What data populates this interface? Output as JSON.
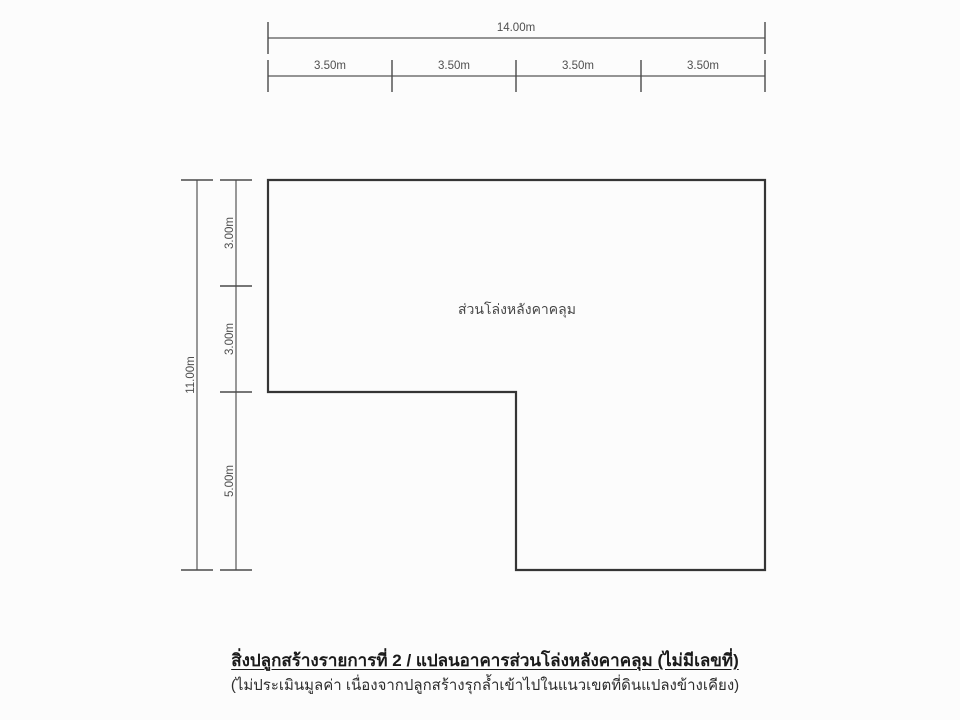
{
  "drawing": {
    "top_dimension": {
      "total_label": "14.00m",
      "segment_labels": [
        "3.50m",
        "3.50m",
        "3.50m",
        "3.50m"
      ]
    },
    "left_dimension": {
      "total_label": "11.00m",
      "segment_labels": [
        "3.00m",
        "3.00m",
        "5.00m"
      ]
    },
    "plan": {
      "area_label": "ส่วนโล่งหลังคาคลุม"
    }
  },
  "caption": {
    "title": "สิ่งปลูกสร้างรายการที่ 2 / แปลนอาคารส่วนโล่งหลังคาคลุม (ไม่มีเลขที่)",
    "subtitle": "(ไม่ประเมินมูลค่า เนื่องจากปลูกสร้างรุกล้ำเข้าไปในแนวเขตที่ดินแปลงข้างเคียง)"
  },
  "colors": {
    "background": "#fcfcfc",
    "outline_line": "#353535",
    "dimension_line": "#565656",
    "dimension_text": "#4f4f4f",
    "caption_text": "#1a1a1a"
  }
}
